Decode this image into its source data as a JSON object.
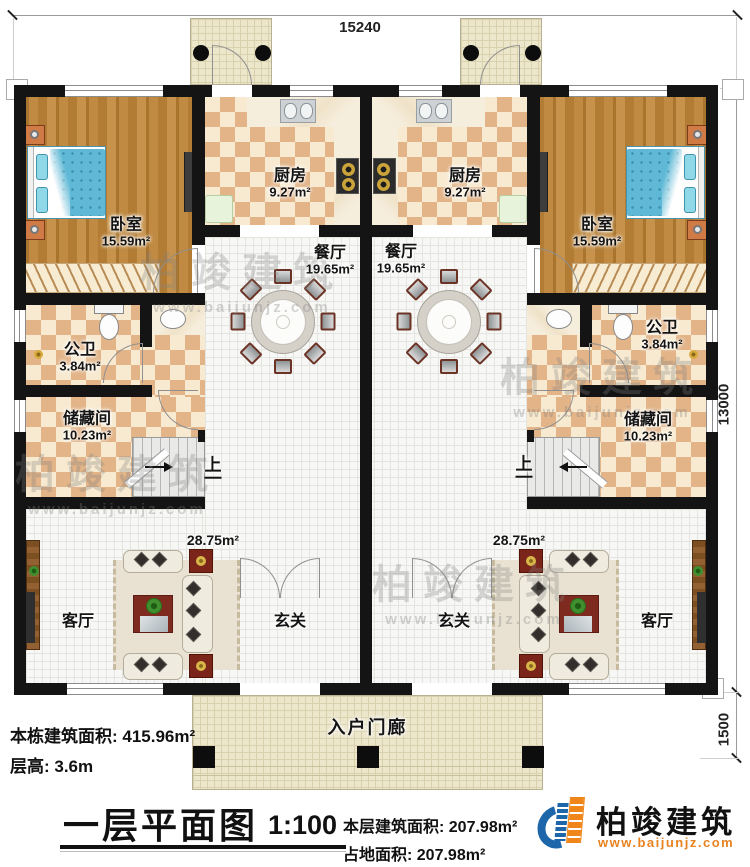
{
  "title": {
    "text": "一层平面图",
    "scale": "1:100"
  },
  "dimensions": {
    "top_width": "15240",
    "side_height": "13000",
    "porch_depth": "1500"
  },
  "rooms": {
    "bedroom": {
      "name": "卧室",
      "area": "15.59m²"
    },
    "kitchen": {
      "name": "厨房",
      "area": "9.27m²"
    },
    "dining": {
      "name": "餐厅",
      "area": "19.65m²"
    },
    "bathroom": {
      "name": "公卫",
      "area": "3.84m²"
    },
    "storage": {
      "name": "储藏间",
      "area": "10.23m²"
    },
    "living": {
      "name": "客厅",
      "area": "28.75m²"
    },
    "foyer": {
      "name": "玄关"
    },
    "entry_porch": {
      "name": "入户门廊"
    },
    "stair_up": "上"
  },
  "stats": {
    "building_total": "本栋建筑面积: 415.96m²",
    "floor_height": "层高: 3.6m",
    "floor_area": "本层建筑面积: 207.98m²",
    "footprint": "占地面积: 207.98m²"
  },
  "brand": {
    "name": "柏竣建筑",
    "site": "www.baijunjz.com"
  }
}
